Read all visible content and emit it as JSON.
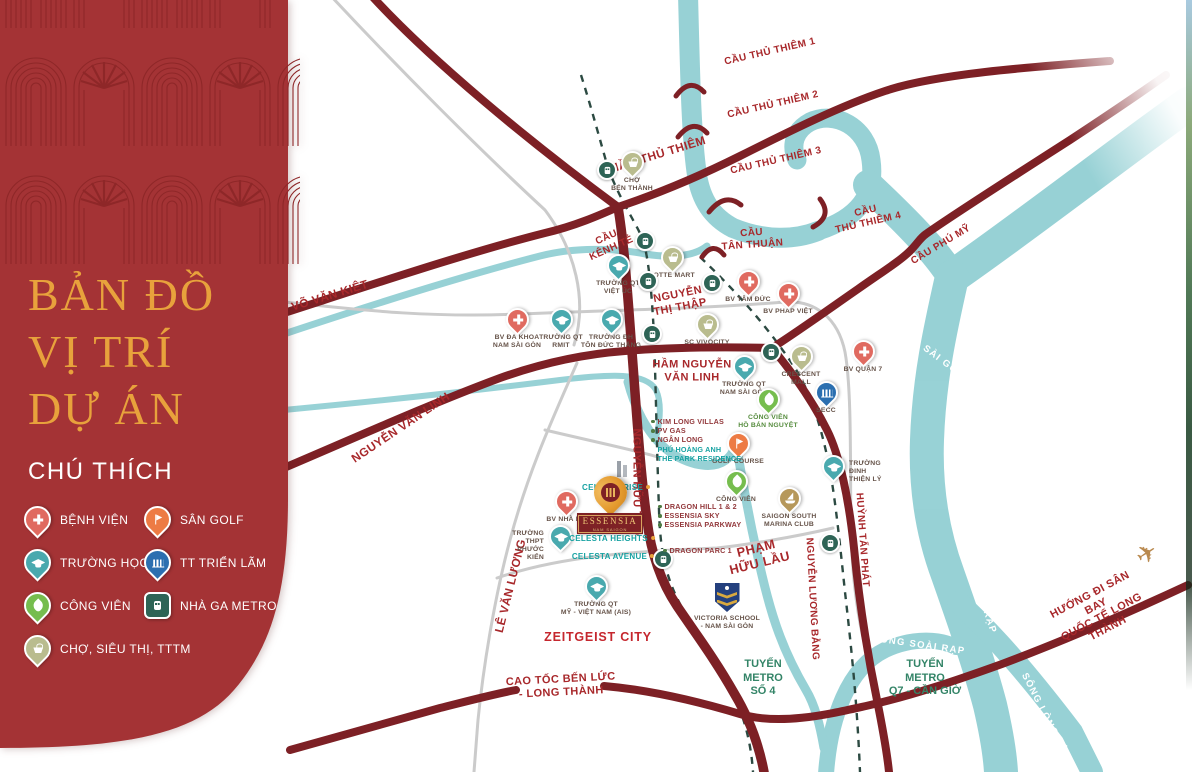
{
  "sidebar": {
    "title_lines": [
      "BẢN ĐỒ",
      "VỊ TRÍ",
      "DỰ ÁN"
    ],
    "legend_title": "CHÚ THÍCH",
    "legend": [
      {
        "icon": "hospital-pin",
        "label": "BỆNH VIỆN"
      },
      {
        "icon": "golf-pin",
        "label": "SÂN GOLF"
      },
      {
        "icon": "school-pin",
        "label": "TRƯỜNG HỌC"
      },
      {
        "icon": "exhibition-pin",
        "label": "TT TRIỂN LÃM"
      },
      {
        "icon": "park-pin",
        "label": "CÔNG VIÊN"
      },
      {
        "icon": "metro-pin",
        "label": "NHÀ GA METRO"
      },
      {
        "icon": "market-pin",
        "label": "CHỢ, SIÊU THỊ, TTTM"
      }
    ]
  },
  "project": {
    "name": "ESSENSIA",
    "subtitle": "NAM SAIGON",
    "listings": [
      "CELESTA RISE",
      "CELESTA HEIGHTS",
      "CELESTA AVENUE"
    ]
  },
  "map": {
    "road_labels": [
      "VÕ VĂN KIỆT",
      "NGUYỄN VĂN LINH",
      "CẦU\nKÊNH TẺ",
      "HẦM THỦ THIÊM",
      "CẦU THỦ THIÊM 1",
      "CẦU THỦ THIÊM 2",
      "CẦU THỦ THIÊM 3",
      "CẦU\nTHỦ THIÊM 4",
      "CẦU\nTÂN THUẬN",
      "CẦU PHÚ MỸ",
      "NGUYỄN\nTHỊ THẬP",
      "HẦM NGUYỄN\nVĂN LINH",
      "NGUYỄN HỮU THỌ",
      "PHẠM\nHỮU LẦU",
      "LÊ VĂN LƯƠNG",
      "HUỲNH TẤN PHÁT",
      "NGUYỄN LƯƠNG BẰNG",
      "CAO TỐC BẾN LỨC\n- LONG THÀNH",
      "HƯỚNG ĐI SÂN BAY\nQUỐC TẾ LONG THÀNH"
    ],
    "river_labels": [
      "SÔNG SÀI GÒN",
      "SÔNG SOÀI RẠP",
      "SÔNG SOÀI RẠP",
      "SÔNG LÒNG TÀU"
    ],
    "metro_labels": [
      "TUYẾN\nMETRO\nSỐ 4",
      "TUYẾN\nMETRO\nQ7 - CẦN GIỜ"
    ],
    "area_labels": [
      "ZEITGEIST CITY"
    ],
    "pois": [
      {
        "type": "hospital",
        "name": "BV ĐA KHOA\nNAM SÀI GÒN"
      },
      {
        "type": "hospital",
        "name": "BV TÂM ĐỨC"
      },
      {
        "type": "hospital",
        "name": "BV PHÁP VIỆT"
      },
      {
        "type": "hospital",
        "name": "BV QUẬN 7"
      },
      {
        "type": "hospital",
        "name": "BV NHÀ BÈ"
      },
      {
        "type": "school",
        "name": "TRƯỜNG QT\nRMIT"
      },
      {
        "type": "school",
        "name": "TRƯỜNG ĐH\nTÔN ĐỨC THẮNG"
      },
      {
        "type": "school",
        "name": "TRƯỜNG QT\nVIỆT ÚC"
      },
      {
        "type": "school",
        "name": "TRƯỜNG QT\nNAM SÀI GÒN"
      },
      {
        "type": "school",
        "name": "TRƯỜNG\nĐINH THIỆN LÝ"
      },
      {
        "type": "school",
        "name": "TRƯỜNG THPT\nPHƯỚC KIỂN"
      },
      {
        "type": "school",
        "name": "TRƯỜNG QT\nMỸ - VIỆT NAM (AIS)"
      },
      {
        "type": "market",
        "name": "CHỢ\nBẾN THÀNH"
      },
      {
        "type": "market",
        "name": "LOTTE MART"
      },
      {
        "type": "market",
        "name": "SC VIVOCITY"
      },
      {
        "type": "market",
        "name": "CRESCENT\nMALL"
      },
      {
        "type": "park",
        "name": "CÔNG VIÊN\nHỒ BÁN NGUYỆT"
      },
      {
        "type": "golf",
        "name": "GOLF COURSE"
      },
      {
        "type": "park",
        "name": "CÔNG VIÊN"
      },
      {
        "type": "exhibition",
        "name": "SECC"
      },
      {
        "type": "marina",
        "name": "SAIGON SOUTH\nMARINA CLUB"
      },
      {
        "type": "school-crest",
        "name": "VICTORIA SCHOOL\n- NAM SÀI GÒN"
      }
    ],
    "nearby_a": [
      "KIM LONG VILLAS",
      "PV GAS",
      "NGÂN LONG",
      "PHÚ HOÀNG ANH",
      "THE PARK RESIDENCE"
    ],
    "nearby_b": [
      "DRAGON HILL 1 & 2",
      "ESSENSIA SKY",
      "ESSENSIA PARKWAY"
    ],
    "nearby_c": [
      "DRAGON PARC 1"
    ],
    "icons": {
      "airplane": "✈"
    },
    "colors": {
      "sidebar": "#A43335",
      "gold": "#E8A23C",
      "road": "#7D2025",
      "river": "#8FCED2",
      "road_label": "#A8282B",
      "hospital": "#E06A60",
      "school": "#49A9AE",
      "park": "#76BD4E",
      "market": "#B9BC8E",
      "golf": "#ED7B44",
      "exhibition": "#2B6FB0",
      "metro": "#2E6456"
    }
  }
}
